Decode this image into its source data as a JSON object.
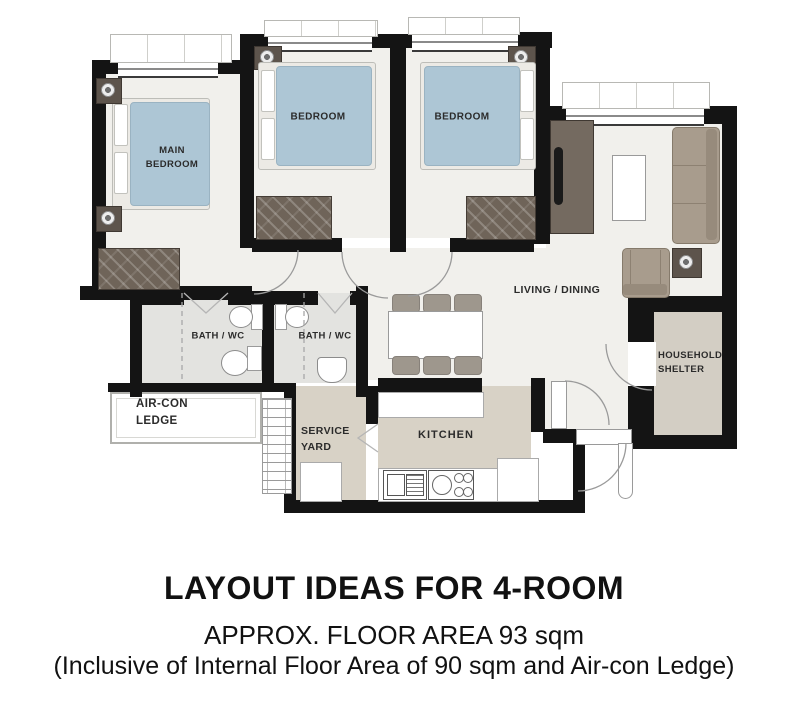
{
  "labels": {
    "main_bedroom": "MAIN BEDROOM",
    "bedroom_2": "BEDROOM",
    "bedroom_3": "BEDROOM",
    "bath_1": "BATH / WC",
    "bath_2": "BATH / WC",
    "aircon_ledge": "AIR-CON LEDGE",
    "service_yard": "SERVICE YARD",
    "kitchen": "KITCHEN",
    "living_dining": "LIVING / DINING",
    "household_shelter": "HOUSEHOLD SHELTER"
  },
  "caption": {
    "title": "LAYOUT IDEAS FOR 4-ROOM",
    "subtitle": "APPROX. FLOOR AREA 93 sqm",
    "note": "(Inclusive of Internal Floor Area of 90 sqm and Air-con Ledge)"
  },
  "colors": {
    "wall": "#141414",
    "floor": "#f1f0ec",
    "bed_blue": "#adc6d5",
    "wardrobe_brown": "#6f6459",
    "sofa_taupe": "#a89c8d",
    "kitchen_beige": "#d8d2c6",
    "bath_grey": "#e3e3e0",
    "shelter_beige": "#d3cec4",
    "chair_grey": "#9e978d",
    "dark_wood": "#5d544c"
  }
}
